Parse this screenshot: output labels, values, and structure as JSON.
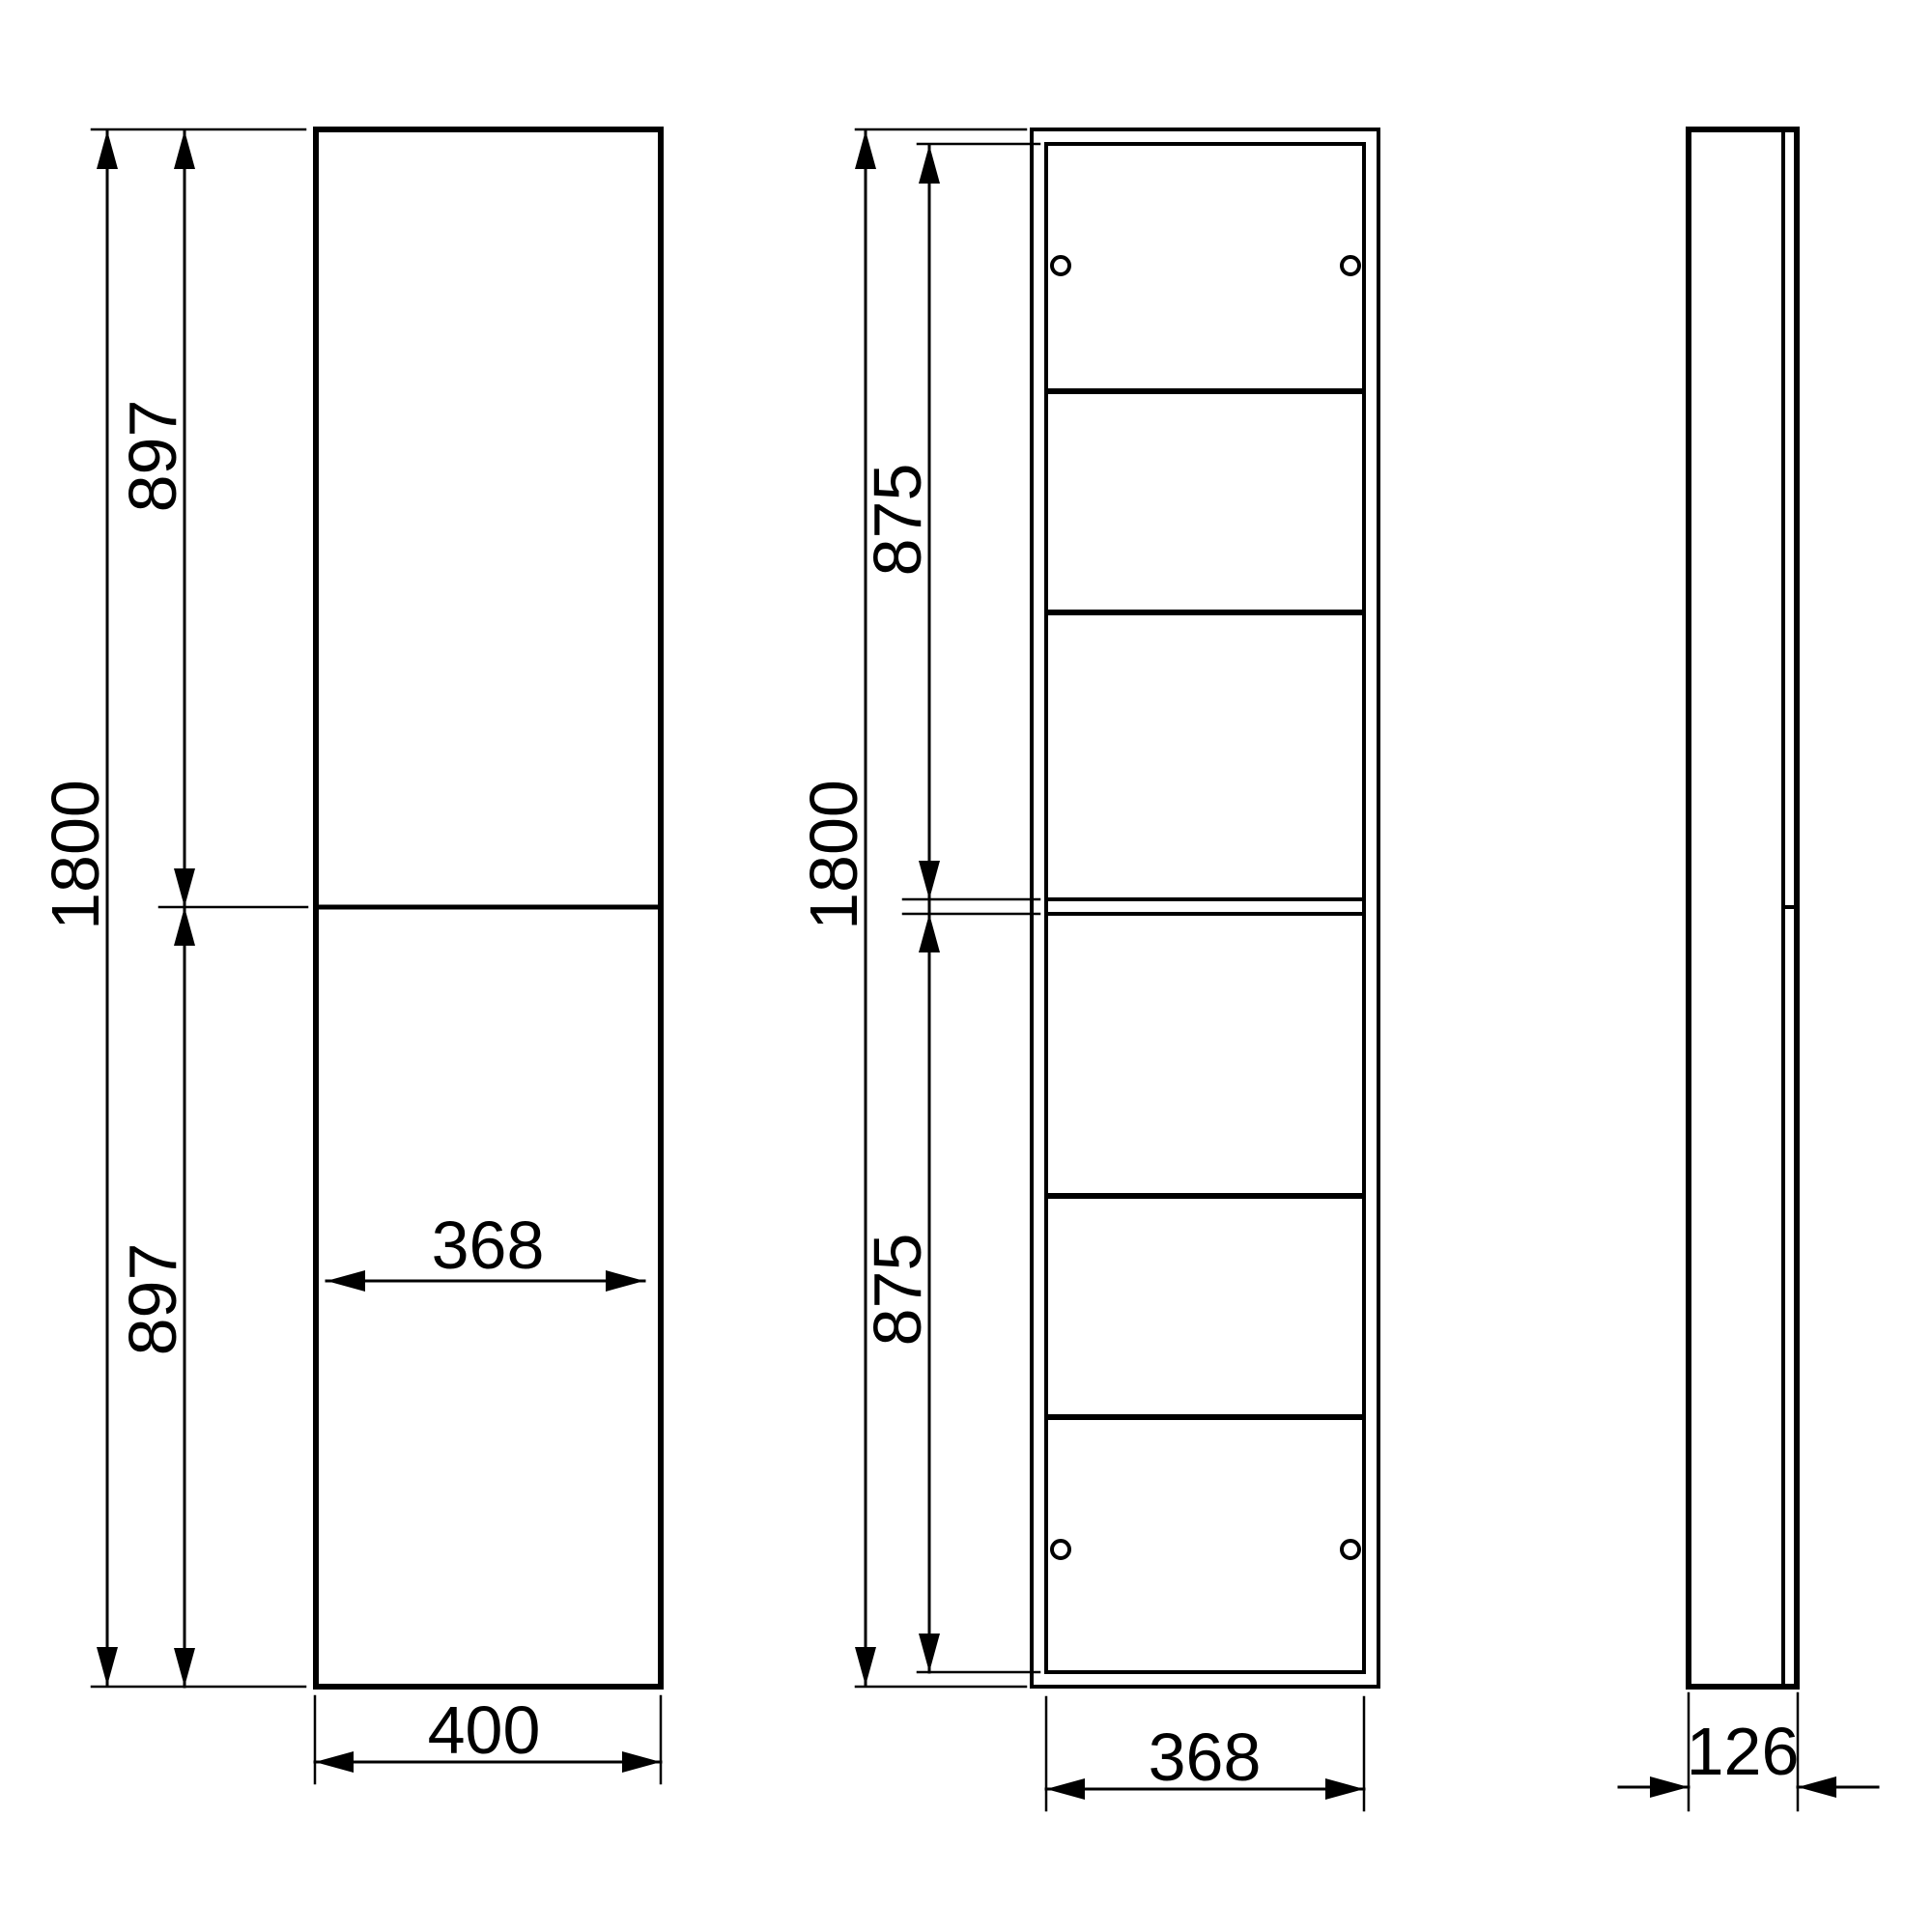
{
  "drawing": {
    "type": "technical-dimension-drawing",
    "background_color": "#ffffff",
    "line_color": "#000000",
    "views": {
      "front": {
        "label": "front-view-with-doors",
        "dims": {
          "total_height": "1800",
          "upper_door_height": "897",
          "lower_door_height": "897",
          "total_width": "400",
          "inner_width": "368"
        }
      },
      "internal": {
        "label": "front-view-internal-shelves",
        "dims": {
          "total_height": "1800",
          "upper_compartment_height": "875",
          "lower_compartment_height": "875",
          "inner_width": "368"
        },
        "shelf_count": 4,
        "pin_hole_count": 4
      },
      "side": {
        "label": "side-view",
        "dims": {
          "depth": "126"
        }
      }
    }
  }
}
